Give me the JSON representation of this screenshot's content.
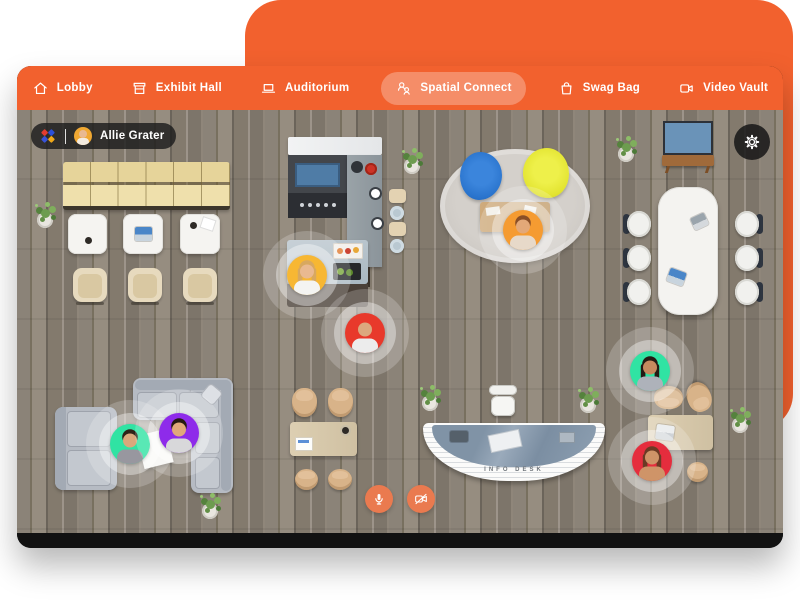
{
  "header": {
    "nav": [
      {
        "label": "Lobby",
        "icon": "home-icon",
        "active": false
      },
      {
        "label": "Exhibit Hall",
        "icon": "storefront-icon",
        "active": false
      },
      {
        "label": "Auditorium",
        "icon": "laptop-icon",
        "active": false
      },
      {
        "label": "Spatial Connect",
        "icon": "users-icon",
        "active": true
      },
      {
        "label": "Swag Bag",
        "icon": "shopping-bag-icon",
        "active": false
      },
      {
        "label": "Video Vault",
        "icon": "video-camera-icon",
        "active": false
      }
    ]
  },
  "user_badge": {
    "name": "Allie Grater",
    "avatar_color": "#F0A832"
  },
  "map": {
    "info_desk_label": "INFO DESK",
    "settings_button": {
      "icon": "gear-icon"
    },
    "controls": [
      {
        "id": "microphone",
        "icon": "microphone-icon",
        "state": "on"
      },
      {
        "id": "camera",
        "icon": "camera-off-icon",
        "state": "off"
      }
    ],
    "participants": [
      {
        "id": "participant-1",
        "halo_color": "#F7B733",
        "hair": "#d8a85f",
        "hairstyle": "long",
        "skin": "#e9b990",
        "shirt": "#f4f4f2",
        "x": 290,
        "y": 165
      },
      {
        "id": "participant-2",
        "halo_color": "#E8392B",
        "hair": "none",
        "hairstyle": "bald",
        "skin": "#dca87e",
        "shirt": "#ececec",
        "x": 348,
        "y": 223
      },
      {
        "id": "participant-3",
        "halo_color": "#F59B31",
        "hair": "#8a4f26",
        "hairstyle": "short",
        "skin": "#e3a878",
        "shirt": "#e7d9c9",
        "x": 506,
        "y": 120
      },
      {
        "id": "participant-4",
        "halo_color": "#30E3A3",
        "hair": "#2e2218",
        "hairstyle": "short",
        "skin": "#d9a77c",
        "shirt": "#98979f",
        "x": 113,
        "y": 334
      },
      {
        "id": "participant-5",
        "halo_color": "#8E2BEA",
        "hair": "#261a12",
        "hairstyle": "short",
        "skin": "#e0a87a",
        "shirt": "#d8d8da",
        "x": 162,
        "y": 323
      },
      {
        "id": "participant-6",
        "halo_color": "#30E3A3",
        "hair": "#241a14",
        "hairstyle": "long",
        "skin": "#c68a5f",
        "shirt": "#aeb2ba",
        "x": 633,
        "y": 261
      },
      {
        "id": "participant-7",
        "halo_color": "#E52D3D",
        "hair": "#6b3a24",
        "hairstyle": "long",
        "skin": "#cf9468",
        "shirt": "#cf9468",
        "x": 635,
        "y": 351
      }
    ]
  },
  "colors": {
    "brand_orange": "#F2612E",
    "active_nav_pill": "rgba(255,255,255,0.28)",
    "control_button_orange": "#EA7A4F",
    "floor_wood": "#8b8378",
    "rug_gray": "#cbc7c1",
    "beanbag_blue": "#2a74cd",
    "beanbag_yellow": "#e3e431"
  }
}
